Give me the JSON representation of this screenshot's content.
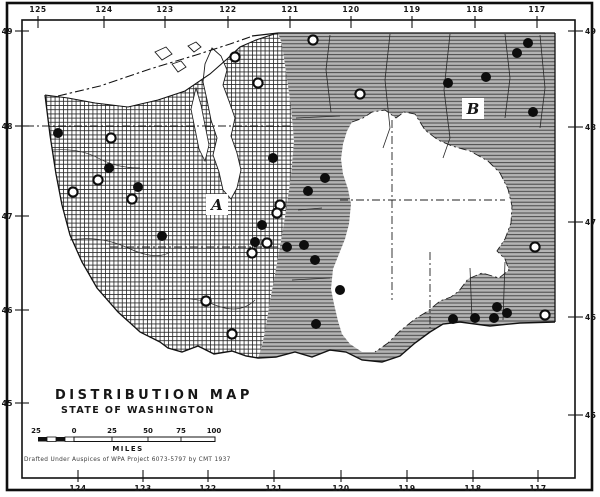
{
  "colors": {
    "ink": "#141414",
    "paper": "#ffffff",
    "region_b_gray": "#b4b4b4",
    "hatch_line": "#2a2a2a"
  },
  "map": {
    "title_line1": "DISTRIBUTION MAP",
    "title_line2": "STATE OF WASHINGTON",
    "credit": "Drafted Under Auspices of WPA Project 6073-5797 by CMT 1937",
    "region_labels": [
      {
        "text": "A",
        "x": 217,
        "y": 210
      },
      {
        "text": "B",
        "x": 473,
        "y": 114
      }
    ]
  },
  "axes": {
    "top_longitude": [
      {
        "label": "125",
        "x": 38
      },
      {
        "label": "124",
        "x": 104
      },
      {
        "label": "123",
        "x": 165
      },
      {
        "label": "122",
        "x": 228
      },
      {
        "label": "121",
        "x": 290
      },
      {
        "label": "120",
        "x": 351
      },
      {
        "label": "119",
        "x": 412
      },
      {
        "label": "118",
        "x": 475
      },
      {
        "label": "117",
        "x": 537
      }
    ],
    "bottom_longitude": [
      {
        "label": "124",
        "x": 78
      },
      {
        "label": "123",
        "x": 143
      },
      {
        "label": "122",
        "x": 208
      },
      {
        "label": "121",
        "x": 274
      },
      {
        "label": "120",
        "x": 341
      },
      {
        "label": "119",
        "x": 407
      },
      {
        "label": "118",
        "x": 473
      },
      {
        "label": "117",
        "x": 538
      }
    ],
    "left_latitude": [
      {
        "label": "49",
        "y": 31
      },
      {
        "label": "48",
        "y": 126
      },
      {
        "label": "47",
        "y": 216
      },
      {
        "label": "46",
        "y": 310
      },
      {
        "label": "45",
        "y": 403
      }
    ],
    "right_latitude": [
      {
        "label": "49",
        "y": 31
      },
      {
        "label": "48",
        "y": 127
      },
      {
        "label": "47",
        "y": 222
      },
      {
        "label": "46",
        "y": 317
      },
      {
        "label": "45",
        "y": 415
      }
    ]
  },
  "scalebar": {
    "tick_labels": [
      "25",
      "0",
      "25",
      "50",
      "75",
      "100"
    ],
    "tick_x": [
      36,
      74,
      112,
      148,
      181,
      214
    ],
    "unit_label": "MILES"
  },
  "markers": {
    "filled_dots": [
      [
        58,
        133
      ],
      [
        109,
        168
      ],
      [
        138,
        187
      ],
      [
        162,
        236
      ],
      [
        273,
        158
      ],
      [
        325,
        178
      ],
      [
        308,
        191
      ],
      [
        262,
        225
      ],
      [
        255,
        242
      ],
      [
        287,
        247
      ],
      [
        304,
        245
      ],
      [
        315,
        260
      ],
      [
        340,
        290
      ],
      [
        316,
        324
      ],
      [
        448,
        83
      ],
      [
        486,
        77
      ],
      [
        517,
        53
      ],
      [
        528,
        43
      ],
      [
        533,
        112
      ],
      [
        453,
        319
      ],
      [
        475,
        318
      ],
      [
        494,
        318
      ],
      [
        497,
        307
      ],
      [
        507,
        313
      ]
    ],
    "open_circles": [
      [
        111,
        138
      ],
      [
        98,
        180
      ],
      [
        73,
        192
      ],
      [
        132,
        199
      ],
      [
        235,
        57
      ],
      [
        258,
        83
      ],
      [
        313,
        40
      ],
      [
        360,
        94
      ],
      [
        280,
        205
      ],
      [
        277,
        213
      ],
      [
        267,
        243
      ],
      [
        252,
        253
      ],
      [
        206,
        301
      ],
      [
        232,
        334
      ],
      [
        535,
        247
      ],
      [
        545,
        315
      ]
    ]
  }
}
